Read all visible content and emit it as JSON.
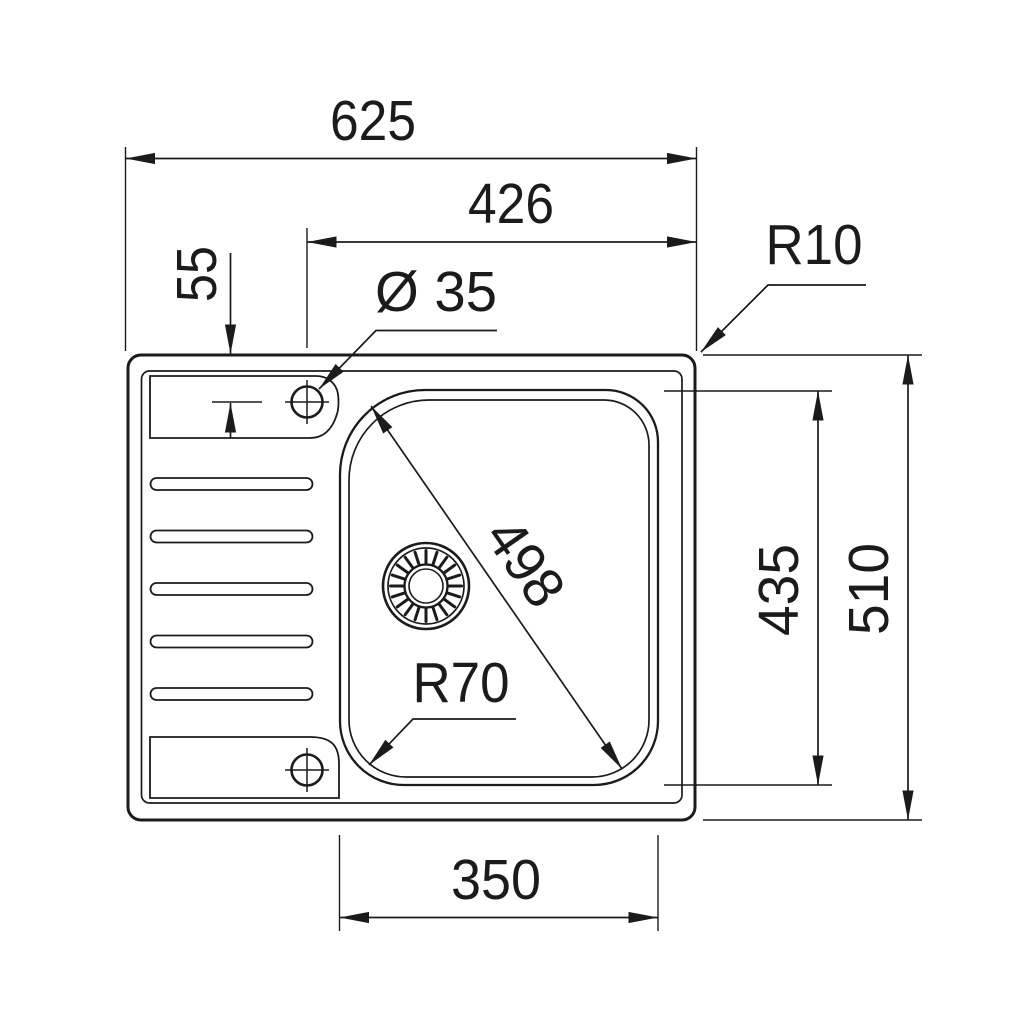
{
  "meta": {
    "drawing_kind": "sink-top-view-dimension-drawing",
    "line_color": "#1b1b1b",
    "background_color": "#ffffff"
  },
  "dims": {
    "overall_width": "625",
    "faucet_to_right_edge": "426",
    "faucet_offset_from_top": "55",
    "faucet_hole_diameter": "Ø 35",
    "rim_corner_radius": "R10",
    "bowl_diagonal": "498",
    "bowl_corner_radius": "R70",
    "bowl_height": "435",
    "overall_height": "510",
    "bowl_bottom_width": "350"
  }
}
